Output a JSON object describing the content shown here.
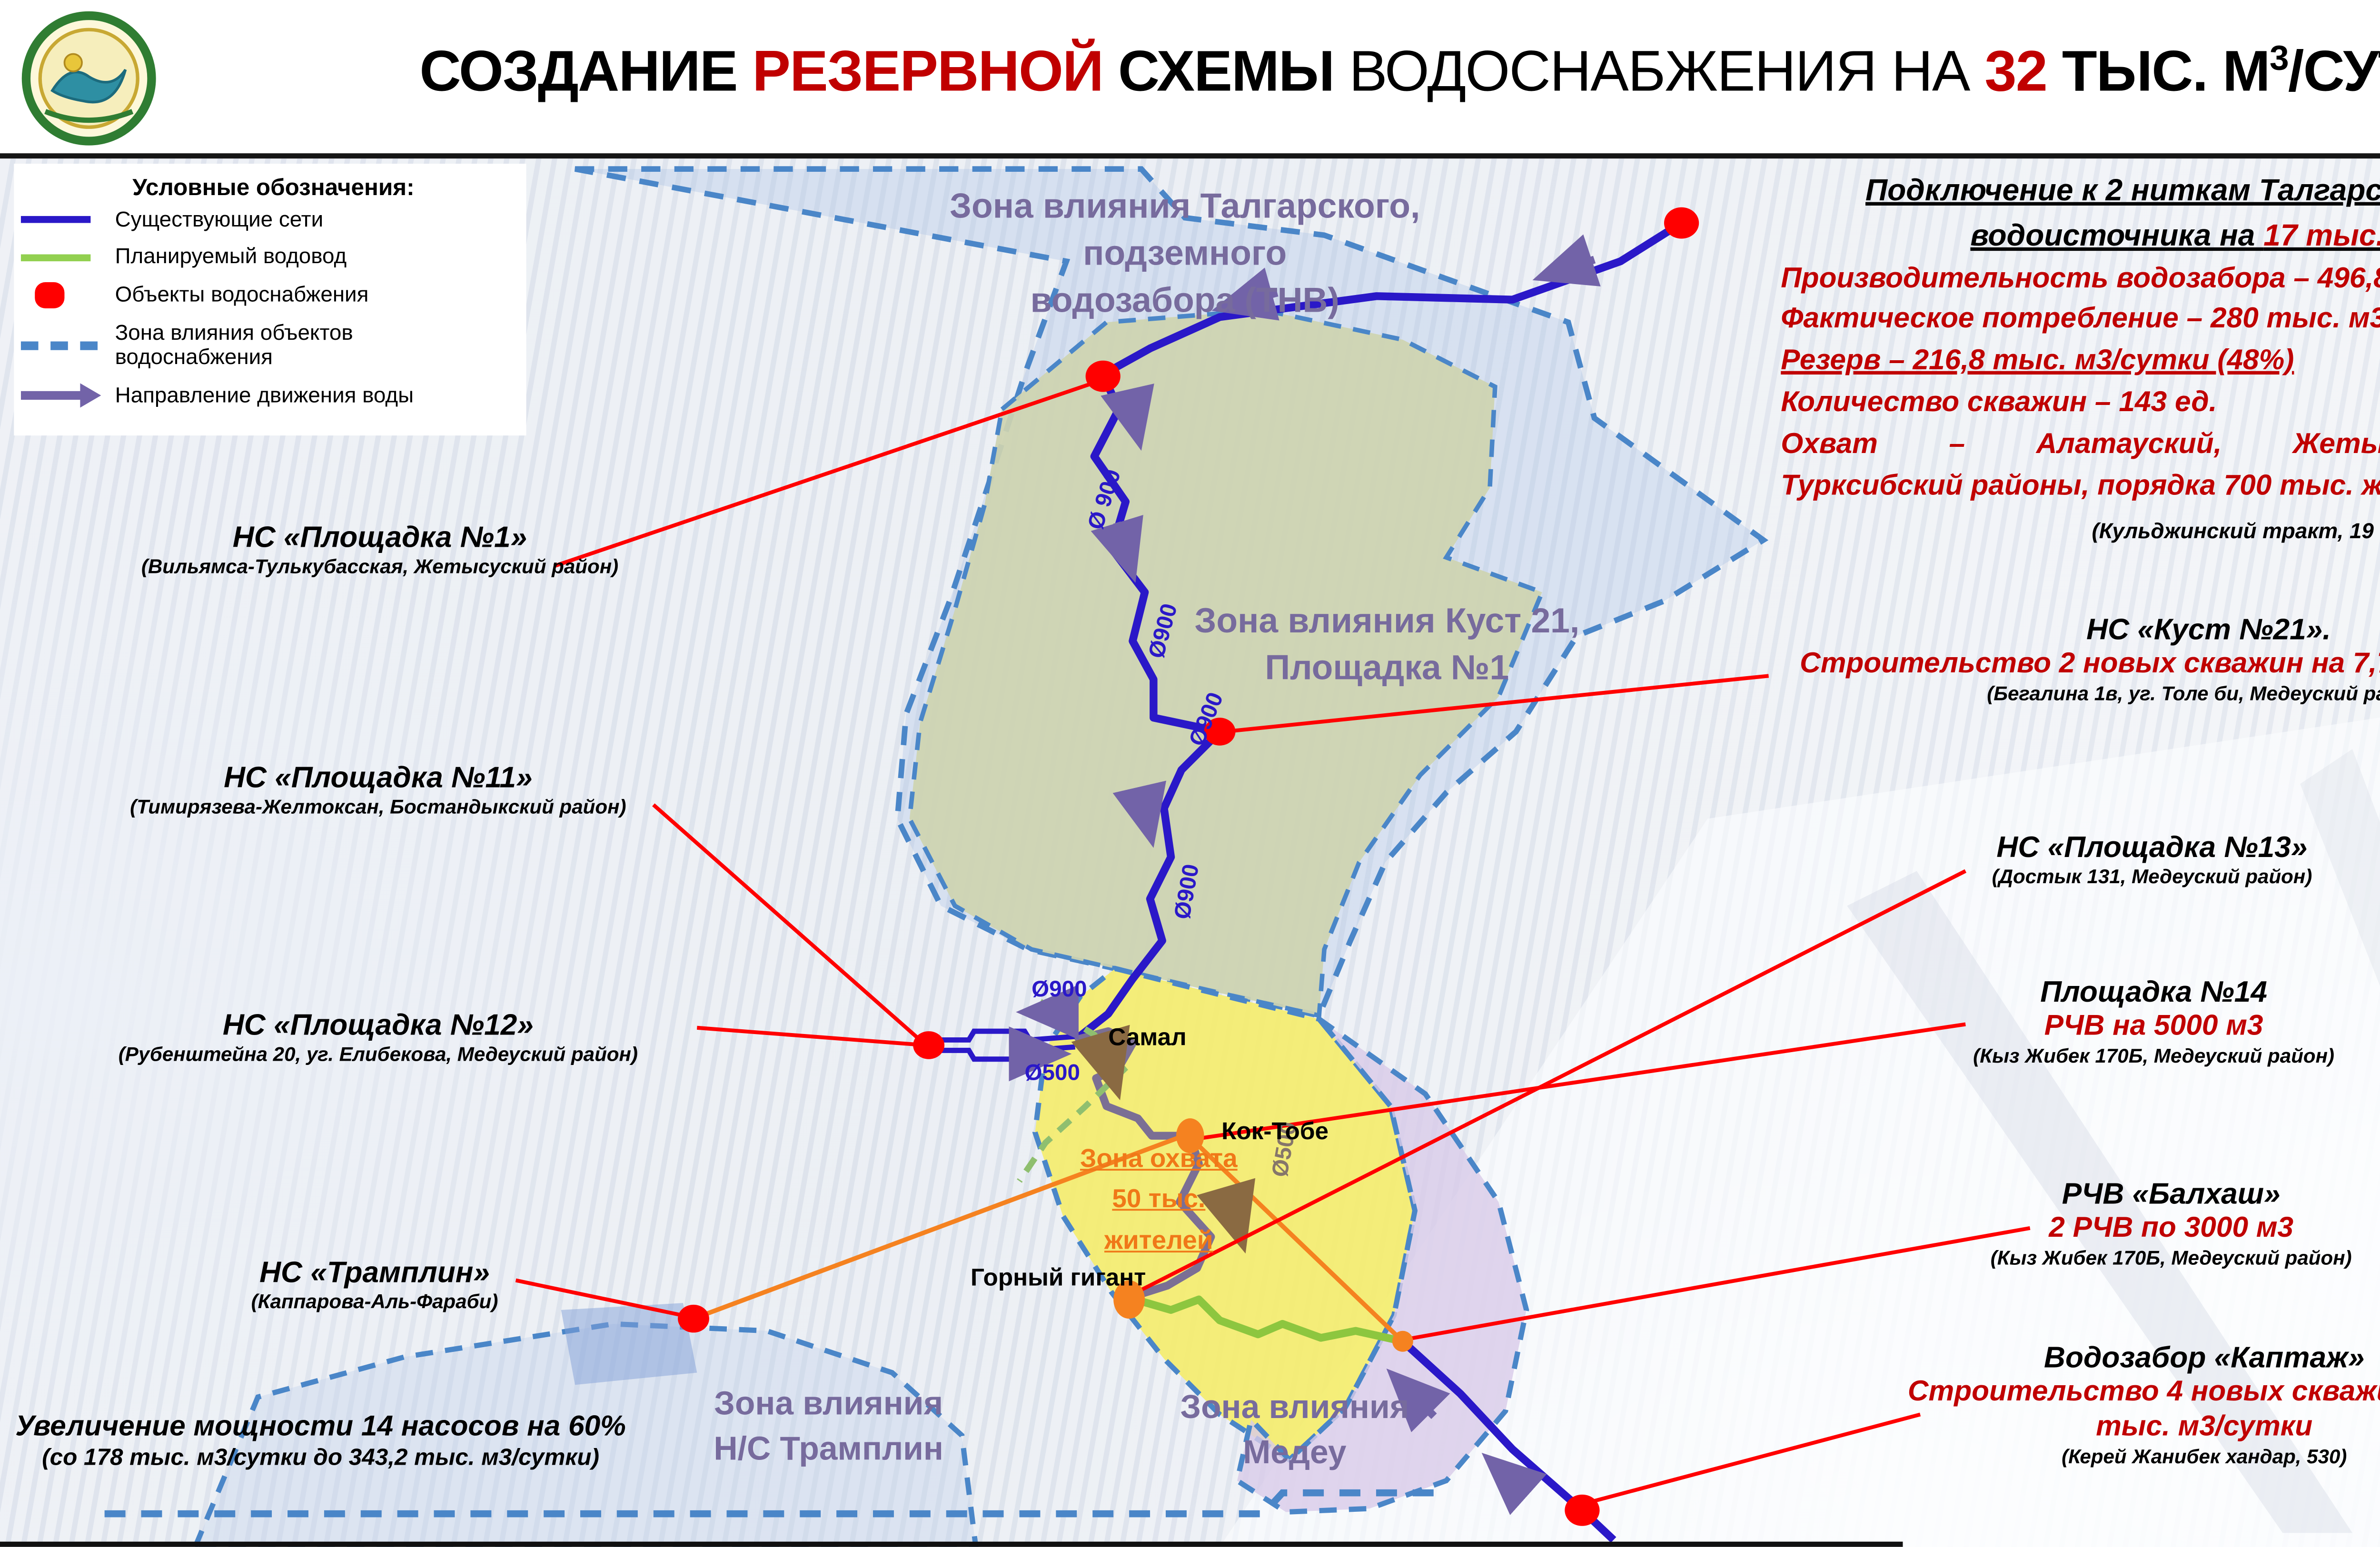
{
  "header": {
    "title_black1": "СОЗДАНИЕ ",
    "title_red1": "РЕЗЕРВНОЙ ",
    "title_black2": "СХЕМЫ ",
    "title_regular": "ВОДОСНАБЖЕНИЯ НА ",
    "title_red2": "32",
    "title_black3": " ТЫС. М",
    "title_sup": "3",
    "title_black4": "/СУТКИ"
  },
  "page_number": "6",
  "legend": {
    "title": "Условные обозначения:",
    "items": [
      {
        "label": "Существующие сети",
        "swatch": "blue-line"
      },
      {
        "label": "Планируемый водовод",
        "swatch": "green-line"
      },
      {
        "label": "Объекты водоснабжения",
        "swatch": "red-dot"
      },
      {
        "label": "Зона влияния объектов водоснабжения",
        "swatch": "blue-dashed-line"
      },
      {
        "label": "Направление движения воды",
        "swatch": "purple-arrow"
      }
    ]
  },
  "info_block": {
    "head_line1": "Подключение к 2 ниткам Талгарского подземного",
    "head_line2_pre": "водоисточника на ",
    "head_line2_red": "17 тыс.",
    "head_line2_post": " м3/сутки",
    "line_productivity": "Производительность водозабора – 496,8 тыс. м3/сутки",
    "line_consumption": "Фактическое потребление – 280 тыс. м3/сутки",
    "line_reserve": "Резерв – 216,8 тыс. м3/сутки (48%)",
    "line_wells": "Количество скважин – 143 ед.",
    "line_coverage1": "Охват – Алатауский, Жетысуский, Медеуский,",
    "line_coverage2": "Турксибский районы, порядка 700 тыс. жителей",
    "note": "(Кульджинский тракт, 19 км)"
  },
  "callouts_left": [
    {
      "title": "НС «Площадка №1»",
      "subtitle": "(Вильямса-Тулькубасская, Жетысуский район)"
    },
    {
      "title": "НС «Площадка №11»",
      "subtitle": "(Тимирязева-Желтоксан, Бостандыкский район)"
    },
    {
      "title": "НС «Площадка №12»",
      "subtitle": "(Рубенштейна 20, уг. Елибекова, Медеуский район)"
    },
    {
      "title": "НС «Трамплин»",
      "subtitle": "(Каппарова-Аль-Фараби)"
    }
  ],
  "pump_upgrade": {
    "line1": "Увеличение мощности 14 насосов на 60%",
    "line2": "(со 178 тыс. м3/сутки до 343,2 тыс. м3/сутки)"
  },
  "callouts_right": [
    {
      "title": "НС «Куст №21».",
      "highlight": "Строительство 2 новых скважин на 7,7 тыс. м3/сутки",
      "subtitle": "(Бегалина 1в, уг. Толе би, Медеуский район)"
    },
    {
      "title": "НС «Площадка №13»",
      "highlight": "",
      "subtitle": "(Достык 131, Медеуский район)"
    },
    {
      "title": "Площадка №14",
      "highlight": "РЧВ на 5000 м3",
      "subtitle": "(Кыз Жибек 170Б, Медеуский район)"
    },
    {
      "title": "РЧВ «Балхаш»",
      "highlight": "2 РЧВ по 3000 м3",
      "subtitle": "(Кыз Жибек 170Б, Медеуский район)"
    },
    {
      "title": "Водозабор «Каптаж»",
      "highlight": "Строительство 4 новых скважин на 7,3 тыс. м3/сутки",
      "subtitle": "(Керей Жанибек хандар, 530)"
    }
  ],
  "map": {
    "zone_labels": [
      {
        "line1": "Зона влияния Талгарского, подземного",
        "line2": "водозабора (ТНВ)"
      },
      {
        "line1": "Зона влияния Куст 21,",
        "line2": "Площадка №1"
      },
      {
        "line1": "Зона влияния",
        "line2": "Н/С Трамплин"
      },
      {
        "line1": "Зона влияния",
        "line2": "Медеу"
      }
    ],
    "places": [
      "Самал",
      "Кок-Тобе",
      "Горный гигант"
    ],
    "coverage": {
      "line1": "Зона охвата",
      "line2": "50 тыс.",
      "line3": "жителей"
    },
    "pipe_labels": [
      "Ø 900",
      "Ø900",
      "Ø900",
      "Ø900",
      "Ø900",
      "Ø500",
      "Ø500"
    ]
  },
  "colors": {
    "accent_red_text": "#c00000",
    "leader_red": "#ff0000",
    "existing_network_blue": "#2a18c8",
    "planned_green": "#92d050",
    "zone_border_blue": "#4a86c8",
    "flow_arrow_purple": "#7263a8",
    "zone_label_purple": "#776b9d",
    "orange_object": "#f07818"
  }
}
